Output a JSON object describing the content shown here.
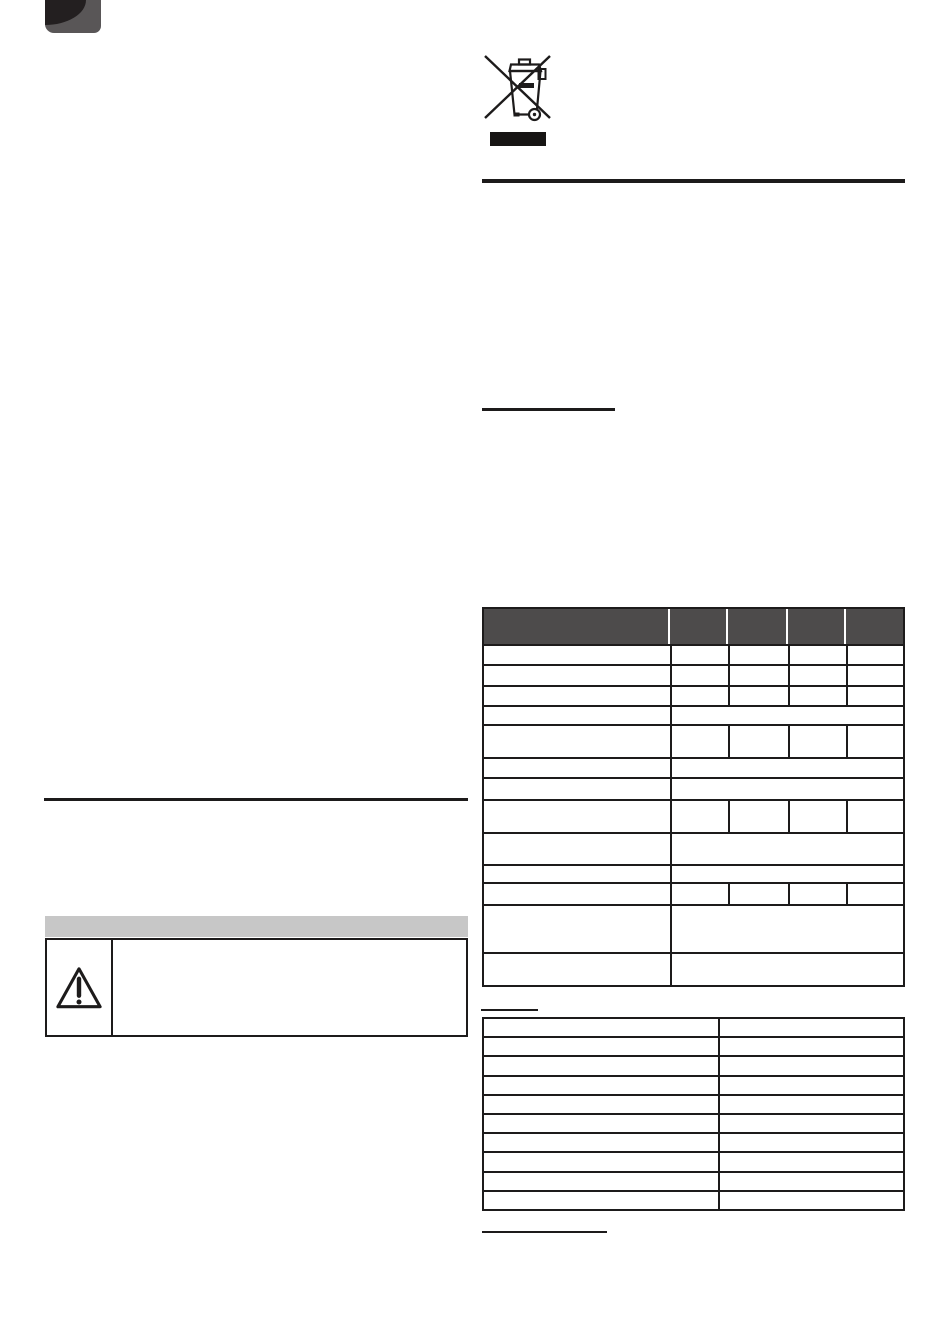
{
  "page": {
    "background": "#ffffff",
    "ink": "#1d1b1b"
  },
  "corner_tab": {
    "icon": "page-corner-tab",
    "gray_color": "#595657",
    "dark_color": "#231f20"
  },
  "weee_symbol": {
    "icon": "weee-crossed-out-wheelie-bin-icon",
    "black_bar_color": "#171514",
    "stroke_color": "#1d1b1b"
  },
  "headings": {
    "right_heading_underline": "",
    "table_heading_underline": "",
    "footer_heading_underline": ""
  },
  "spec_table": {
    "border_color": "#1d1b1b",
    "header": {
      "background": "#4d4b4b",
      "divider_color": "#ffffff",
      "height": 35,
      "labels": [
        "",
        "",
        "",
        "",
        ""
      ]
    },
    "column_widths": [
      188,
      58,
      60,
      58,
      59
    ],
    "rows": [
      {
        "height": 20,
        "right_side": "split",
        "cells": [
          "",
          "",
          "",
          "",
          ""
        ]
      },
      {
        "height": 21,
        "right_side": "split",
        "cells": [
          "",
          "",
          "",
          "",
          ""
        ]
      },
      {
        "height": 20,
        "right_side": "split",
        "cells": [
          "",
          "",
          "",
          "",
          ""
        ]
      },
      {
        "height": 19,
        "right_side": "merged",
        "cells": [
          "",
          ""
        ]
      },
      {
        "height": 33,
        "right_side": "split",
        "cells": [
          "",
          "",
          "",
          "",
          ""
        ]
      },
      {
        "height": 20,
        "right_side": "merged",
        "cells": [
          "",
          ""
        ]
      },
      {
        "height": 22,
        "right_side": "merged",
        "cells": [
          "",
          ""
        ]
      },
      {
        "height": 33,
        "right_side": "split",
        "cells": [
          "",
          "",
          "",
          "",
          ""
        ]
      },
      {
        "height": 32,
        "right_side": "merged",
        "cells": [
          "",
          ""
        ]
      },
      {
        "height": 18,
        "right_side": "merged",
        "cells": [
          "",
          ""
        ]
      },
      {
        "height": 22,
        "right_side": "split",
        "cells": [
          "",
          "",
          "",
          "",
          ""
        ]
      },
      {
        "height": 48,
        "right_side": "merged",
        "cells": [
          "",
          ""
        ]
      },
      {
        "height": 33,
        "right_side": "merged",
        "cells": [
          "",
          ""
        ]
      }
    ]
  },
  "info_table": {
    "border_color": "#1d1b1b",
    "row_count": 10,
    "column_widths": [
      238,
      185
    ],
    "rows": [
      [
        "",
        ""
      ],
      [
        "",
        ""
      ],
      [
        "",
        ""
      ],
      [
        "",
        ""
      ],
      [
        "",
        ""
      ],
      [
        "",
        ""
      ],
      [
        "",
        ""
      ],
      [
        "",
        ""
      ],
      [
        "",
        ""
      ],
      [
        "",
        ""
      ]
    ]
  },
  "warning_box": {
    "header_background": "#c7c7c7",
    "header_label": "",
    "icon": "warning-triangle-icon",
    "message": ""
  }
}
